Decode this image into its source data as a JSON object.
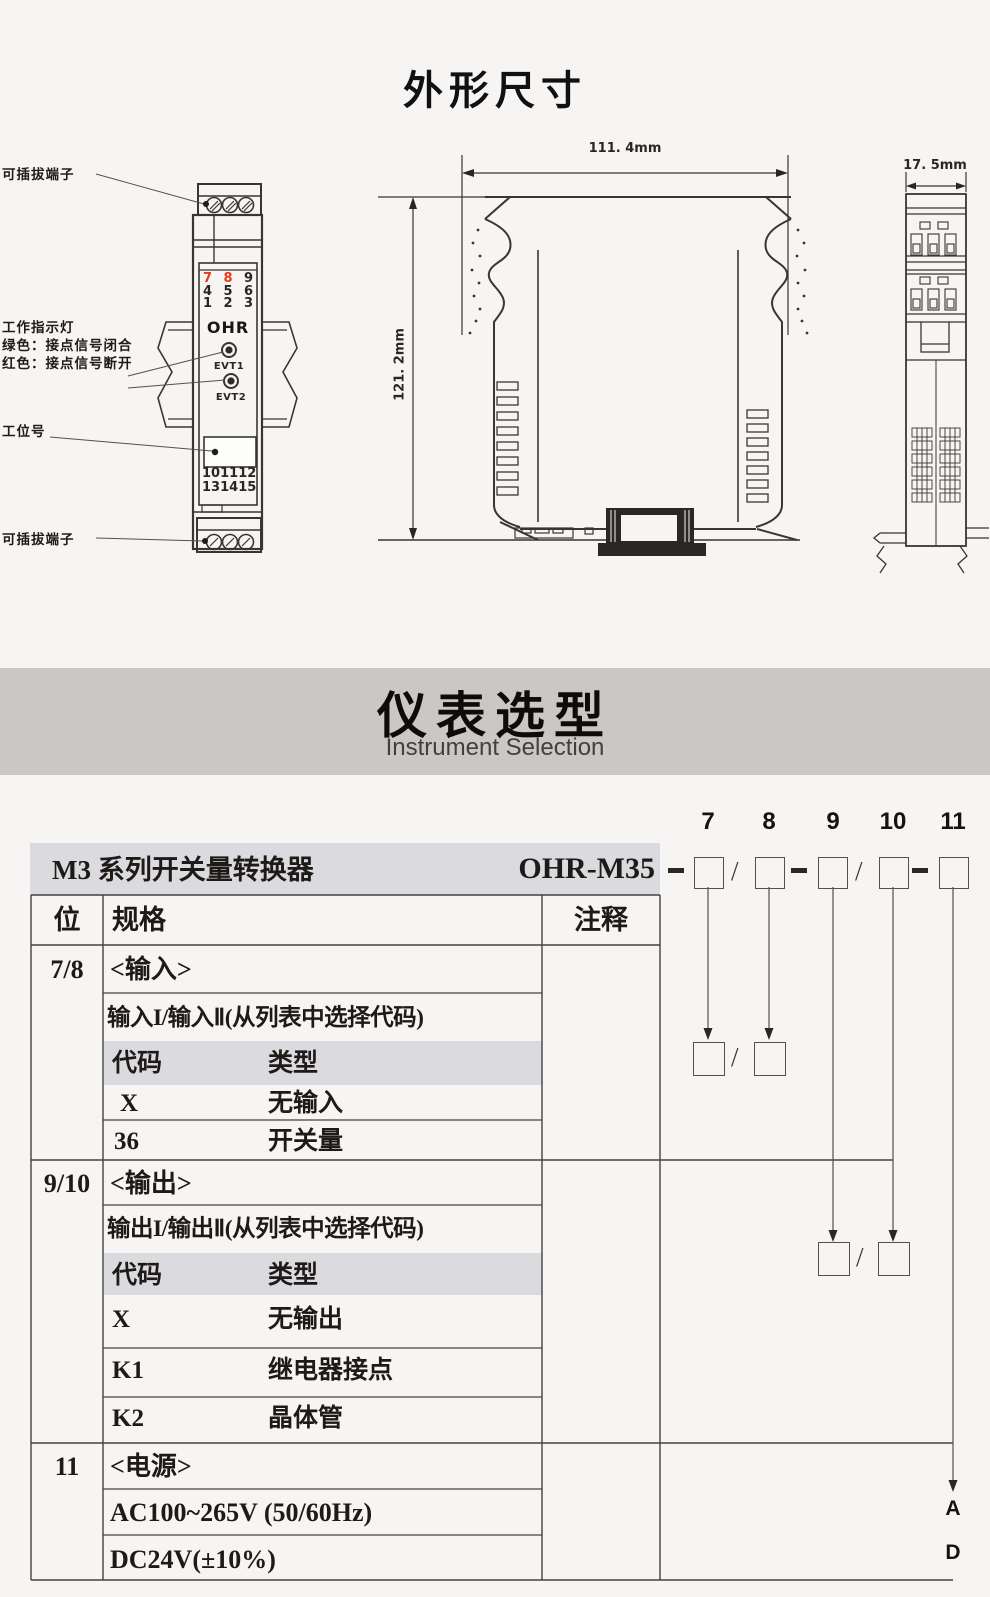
{
  "titles": {
    "dimensions": "外形尺寸",
    "selection_cn": "仪表选型",
    "selection_en": "Instrument Selection"
  },
  "front_view": {
    "top_terminal_label": "可插拔端子",
    "indicator_label1": "工作指示灯",
    "indicator_label2": "绿色：接点信号闭合",
    "indicator_label3": "红色：接点信号断开",
    "station_label": "工位号",
    "bottom_terminal_label": "可插拔端子",
    "logo": "OHR",
    "led1_label": "EVT1",
    "led2_label": "EVT2",
    "top_numbers": {
      "r1": [
        "7",
        "8",
        "9"
      ],
      "r2": [
        "4",
        "5",
        "6"
      ],
      "r3": [
        "1",
        "2",
        "3"
      ]
    },
    "bottom_numbers": {
      "r1": [
        "10",
        "11",
        "12"
      ],
      "r2": [
        "13",
        "14",
        "15"
      ]
    }
  },
  "side_view": {
    "width_dim": "111. 4mm",
    "height_dim": "121. 2mm"
  },
  "end_view": {
    "width_dim": "17. 5mm"
  },
  "model_code": {
    "positions": [
      "7",
      "8",
      "9",
      "10",
      "11"
    ],
    "dash": "-",
    "slash": "/",
    "power_codes": {
      "ac": "A",
      "dc": "D"
    }
  },
  "table": {
    "series_title": "M3 系列开关量转换器",
    "model": "OHR-M35",
    "header": {
      "pos": "位",
      "spec": "规格",
      "note": "注释"
    },
    "input": {
      "pos": "7/8",
      "title": "<输入>",
      "subtitle": "输入I/输入Ⅱ(从列表中选择代码)",
      "code_col": "代码",
      "type_col": "类型",
      "rows": [
        {
          "code": "X",
          "type": "无输入"
        },
        {
          "code": "36",
          "type": "开关量"
        }
      ]
    },
    "output": {
      "pos": "9/10",
      "title": "<输出>",
      "subtitle": "输出I/输出Ⅱ(从列表中选择代码)",
      "code_col": "代码",
      "type_col": "类型",
      "rows": [
        {
          "code": "X",
          "type": "无输出"
        },
        {
          "code": "K1",
          "type": "继电器接点"
        },
        {
          "code": "K2",
          "type": "晶体管"
        }
      ]
    },
    "power": {
      "pos": "11",
      "title": "<电源>",
      "rows": [
        {
          "label": "AC100~265V (50/60Hz)"
        },
        {
          "label": "DC24V(±10%)"
        }
      ]
    }
  },
  "colors": {
    "banner_bg": "#c9c8c6",
    "table_band_bg": "#dbdade",
    "line": "#46413d",
    "red_accent": "#e8391a"
  }
}
